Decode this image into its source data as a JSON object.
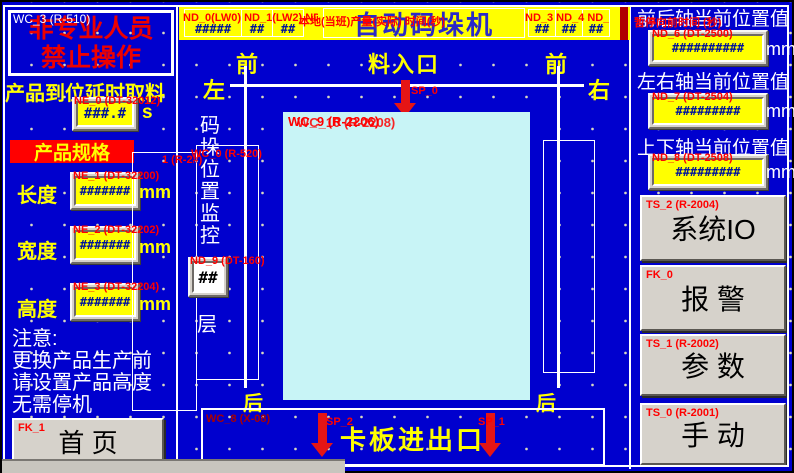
{
  "colors": {
    "background": "#0000CE",
    "banner_yellow": "#FFFF00",
    "accent_red": "#FF0000",
    "pallet_cyan": "#C8F4F6",
    "button_gray": "#D6D2CB",
    "hash_blue": "#00149B"
  },
  "top_banner": {
    "date_displays": [
      "#####",
      "##",
      "##"
    ],
    "date_overlay": "ND_0(LW0) ND_1(LW2) ND_2(LW4)",
    "title": "自动码垛机",
    "title_overlay": "本地(当班)产量(实际) 时间(秒)",
    "time_displays": [
      "##",
      "##",
      "##"
    ],
    "time_overlay": "ND_3 ND_4 ND_5 (LW6)"
  },
  "left_panel": {
    "warning_tag": "WC_3 (R-510)",
    "warning_line1": "非专业人员",
    "warning_line2": "禁止操作",
    "delay_label": "产品到位延时取料",
    "delay_display": {
      "tag": "NE_0 (DT-32012)",
      "value": "###.#",
      "unit": "s"
    },
    "spec_header": "产品规格",
    "spec_rows": [
      {
        "label": "长度",
        "tag": "NE_1 (DT-32200)",
        "value": "#######",
        "unit": "mm"
      },
      {
        "label": "宽度",
        "tag": "NE_2 (DT-32202)",
        "value": "#######",
        "unit": "mm"
      },
      {
        "label": "高度",
        "tag": "NE_3 (DT-32204)",
        "value": "#######",
        "unit": "mm"
      }
    ],
    "note_lines": [
      "注意:",
      "更换产品生产前",
      "请设置产品高度",
      "无需停机"
    ],
    "home_button": {
      "tag": "FK_1",
      "label": "首 页"
    }
  },
  "diagram": {
    "front_left": "前",
    "feed_label": "料入口",
    "front_right": "前",
    "left_label": "左",
    "right_label": "右",
    "feed_arrow_tag": "SP_0",
    "pallet_tag_a": "WC_9 (R-2206)",
    "pallet_tag_b": "WC_10 (R-2208)",
    "monitor_tag_a": "WC_0 (R-520)",
    "monitor_tag_b": "1 (R-2#)",
    "monitor_text": "码垛位置监控",
    "layer_display": {
      "tag": "ND_9 (DT-160)",
      "value": "##"
    },
    "layer_label": "层",
    "rear_left": "后",
    "rear_right": "后",
    "outlet": {
      "tag": "WC_8 (X-08)",
      "label": "卡板进出口",
      "arrow_left_tag": "SP_2",
      "arrow_right_tag": "SP_1"
    }
  },
  "right_panel": {
    "axis1": {
      "title": "前后轴当前位置值",
      "overlay": "暂停向前时间 (秒)",
      "tag": "ND_6 (DT-2500)",
      "value": "##########",
      "unit": "mm"
    },
    "axis2": {
      "title": "左右轴当前位置值",
      "tag": "ND_7 (DT-2504)",
      "value": "#########",
      "unit": "mm"
    },
    "axis3": {
      "title": "上下轴当前位置值",
      "tag": "ND_8 (DT-2508)",
      "value": "#########",
      "unit": "mm"
    },
    "buttons": {
      "system_io": {
        "tag": "TS_2 (R-2004)",
        "label": "系统IO"
      },
      "alarm": {
        "tag": "FK_0",
        "label": "报 警"
      },
      "params": {
        "tag": "TS_1 (R-2002)",
        "label": "参 数"
      },
      "manual": {
        "tag": "TS_0 (R-2001)",
        "label": "手 动"
      }
    }
  }
}
